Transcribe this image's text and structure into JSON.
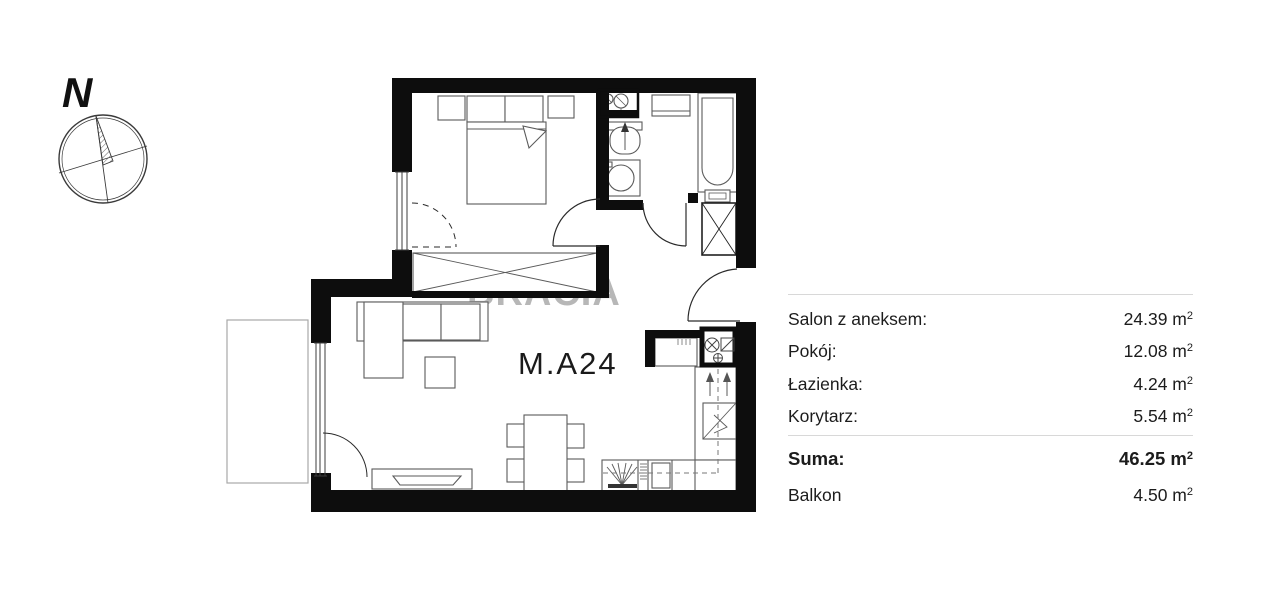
{
  "compass": {
    "north_label": "N"
  },
  "plan": {
    "unit_label": "M.A24",
    "watermark": "BRACIA"
  },
  "areas": {
    "unit": "m",
    "unit_sup": "2",
    "main_rows": [
      {
        "label": "Salon z aneksem:",
        "value": "24.39"
      },
      {
        "label": "Pokój:",
        "value": "12.08"
      },
      {
        "label": "Łazienka:",
        "value": "4.24"
      },
      {
        "label": "Korytarz:",
        "value": "5.54"
      }
    ],
    "summary_rows": [
      {
        "label": "Suma:",
        "value": "46.25",
        "bold": true
      },
      {
        "label": "Balkon",
        "value": "4.50",
        "bold": false
      }
    ]
  },
  "colors": {
    "wall": "#0d0d0d",
    "furniture_line": "#5a5a5a",
    "thin_line": "#8a8a8a",
    "watermark": "#b7b7b7",
    "text": "#1c1c1c",
    "separator": "#d8d8d8"
  }
}
